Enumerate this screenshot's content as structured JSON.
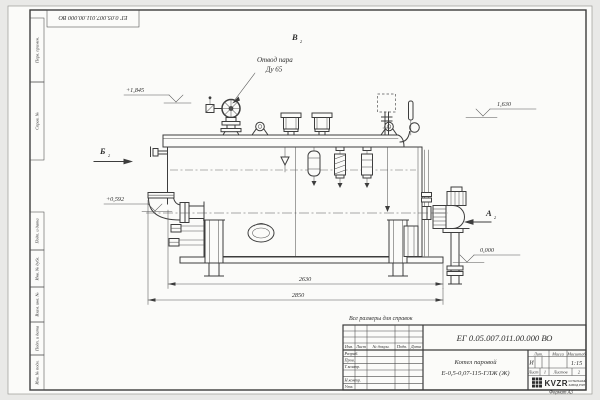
{
  "doc_number": "ЕГ 0.05.007.011.00.000  ВО",
  "sheet": {
    "note": "Все размеры для справок",
    "format_label": "Формат А3",
    "margin_columns": [
      "Перв. примен.",
      "Справ. №",
      "Подп. и дата",
      "Инв. № дубл.",
      "Взам. инв. №",
      "Подп. и дата",
      "Инв. № подл."
    ]
  },
  "drawing": {
    "callout_line1": "Отвод пара",
    "callout_line2": "Ду 65",
    "elevation_top_left": "+1,845",
    "elevation_mid_left": "+0,592",
    "elevation_top_right": "1,630",
    "elevation_ground": "0,000",
    "dim_inner": "2630",
    "dim_outer": "2850",
    "view_a": "А",
    "view_b": "Б",
    "view_v": "В",
    "view_sheet_ref": "2"
  },
  "title_block": {
    "product_line1": "Котел паровой",
    "product_line2": "Е-0,5-0,07-115-ГЛЖ (Ж)",
    "col_izm": "Изм.",
    "col_list": "Лист",
    "col_doc": "№ докум.",
    "col_podp": "Подп.",
    "col_data": "Дата",
    "row_razrab": "Разраб.",
    "row_prov": "Пров.",
    "row_tkontr": "Т.контр.",
    "row_nkontr": "Н.контр.",
    "row_utv": "Утв.",
    "lit_label": "Лит.",
    "mass_label": "Масса",
    "scale_label": "Масштаб",
    "lit_value": "И",
    "scale_value": "1:15",
    "sheet_label": "Лист",
    "sheet_value": "1",
    "sheets_label": "Листов",
    "sheets_value": "2",
    "logo_text": "KVZR",
    "logo_sub1": "КОТЕЛЬНЫЙ",
    "logo_sub2": "ЗАВОД РЭП"
  }
}
